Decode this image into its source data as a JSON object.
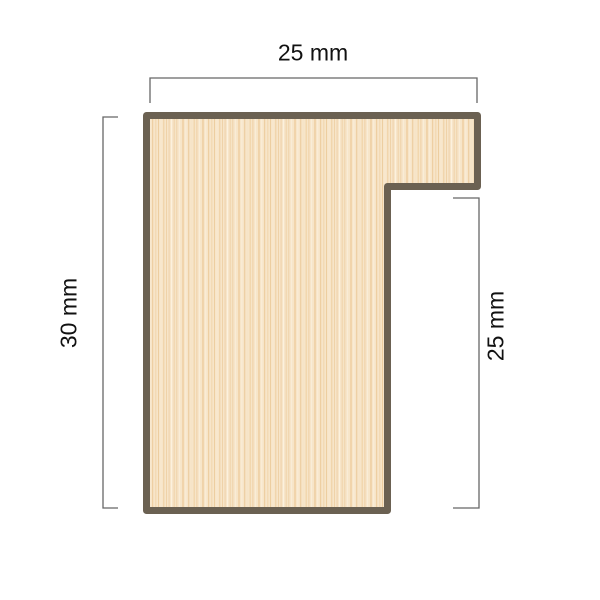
{
  "diagram": {
    "labels": {
      "top": "25 mm",
      "left": "30 mm",
      "right": "25 mm"
    },
    "colors": {
      "wood_fill_base": "#f7e5c9",
      "wood_outline": "#6b6152",
      "dimension_line": "#666666",
      "label_text": "#111111",
      "background": "#ffffff"
    }
  }
}
